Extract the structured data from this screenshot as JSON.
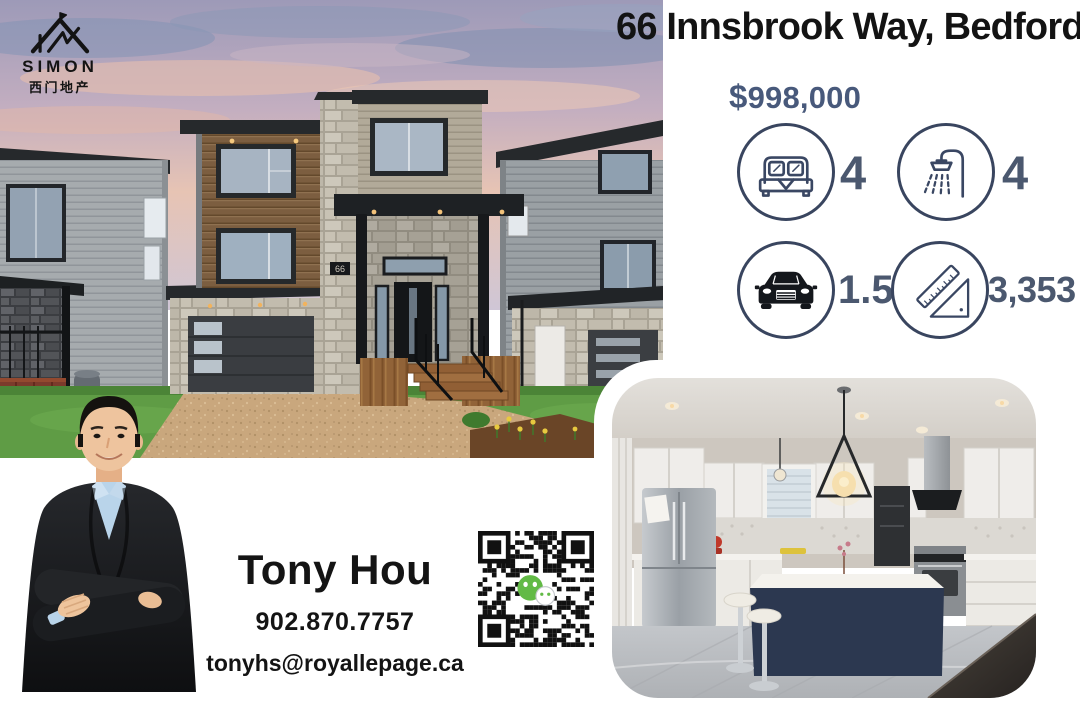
{
  "brand": {
    "name": "SIMON",
    "name_cn": "西门地产",
    "icon": "house-logo-icon"
  },
  "listing": {
    "address": "66 Innsbrook Way, Bedford",
    "currency": "$",
    "price": "998,000",
    "house_number_plaque": "66",
    "stats": [
      {
        "icon": "bed-icon",
        "value": "4"
      },
      {
        "icon": "shower-icon",
        "value": "4"
      },
      {
        "icon": "car-icon",
        "value": "1.5"
      },
      {
        "icon": "ruler-icon",
        "value": "3,353"
      }
    ]
  },
  "agent": {
    "name": "Tony Hou",
    "phone": "902.870.7757",
    "email": "tonyhs@royallepage.ca"
  },
  "photos": {
    "main": "house-exterior-photo",
    "secondary": "kitchen-photo"
  },
  "qr": {
    "icon": "wechat-icon"
  },
  "colors": {
    "heading": "#131313",
    "price": "#48597b",
    "stat_value": "#4b586f",
    "circle_stroke": "#39455f",
    "wechat_green": "#62ba46"
  }
}
